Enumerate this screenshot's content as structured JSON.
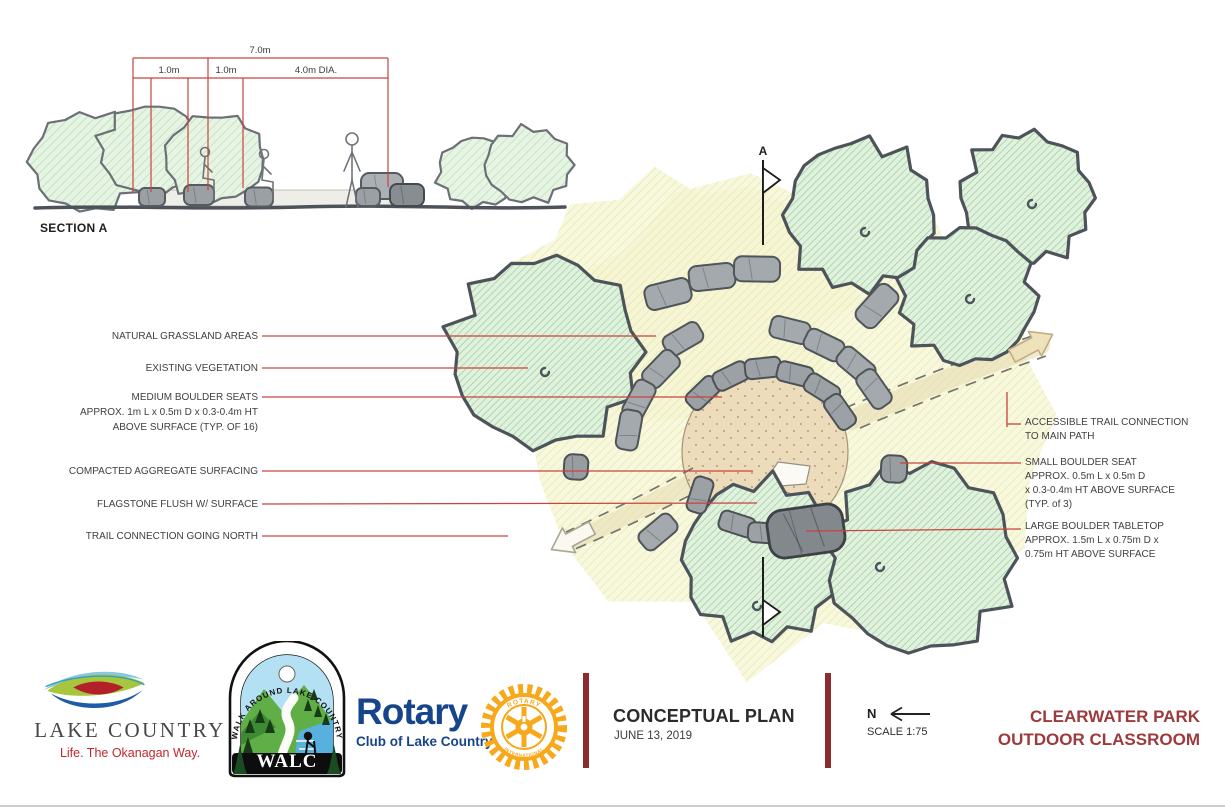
{
  "section": {
    "title": "SECTION A",
    "dims": {
      "overall": "7.0m",
      "d1": "1.0m",
      "d2": "1.0m",
      "d3": "4.0m DIA."
    }
  },
  "plan": {
    "section_marker": "A",
    "callouts_left": [
      {
        "lines": [
          "NATURAL GRASSLAND AREAS"
        ]
      },
      {
        "lines": [
          "EXISTING VEGETATION"
        ]
      },
      {
        "lines": [
          "MEDIUM BOULDER SEATS",
          "APPROX. 1m L x 0.5m D  x 0.3-0.4m HT",
          "ABOVE SURFACE (TYP. OF 16)"
        ]
      },
      {
        "lines": [
          "COMPACTED AGGREGATE SURFACING"
        ]
      },
      {
        "lines": [
          "FLAGSTONE  FLUSH W/ SURFACE"
        ]
      },
      {
        "lines": [
          "TRAIL CONNECTION GOING NORTH"
        ]
      }
    ],
    "callouts_right": [
      {
        "lines": [
          "ACCESSIBLE TRAIL CONNECTION",
          "TO MAIN PATH"
        ]
      },
      {
        "lines": [
          "SMALL BOULDER SEAT",
          "APPROX. 0.5m L x 0.5m D",
          "x 0.3-0.4m HT ABOVE SURFACE",
          "(TYP. of 3)"
        ]
      },
      {
        "lines": [
          "LARGE BOULDER TABLETOP",
          "APPROX. 1.5m L x 0.75m D x",
          "0.75m HT ABOVE SURFACE"
        ]
      }
    ]
  },
  "footer": {
    "lake_country": {
      "name": "LAKE COUNTRY",
      "tagline": "Life. The Okanagan Way."
    },
    "walc": {
      "arc_text": "WALK AROUND LAKE COUNTRY",
      "name": "WALC"
    },
    "rotary": {
      "name": "Rotary",
      "club": "Club of Lake Country",
      "wheel_top": "ROTARY",
      "wheel_bottom": "INTERNATIONAL"
    },
    "titleblock": {
      "title": "CONCEPTUAL PLAN",
      "date": "JUNE 13, 2019"
    },
    "north": {
      "label": "N",
      "scale": "SCALE 1:75"
    },
    "project": {
      "line1": "CLEARWATER PARK",
      "line2": "OUTDOOR CLASSROOM"
    }
  },
  "colors": {
    "annotation_red": "#c9443c",
    "divider_maroon": "#8e2b2e",
    "project_title": "#9d3a3d",
    "rotary_blue": "#17458c",
    "rotary_gold": "#f7a81b"
  }
}
